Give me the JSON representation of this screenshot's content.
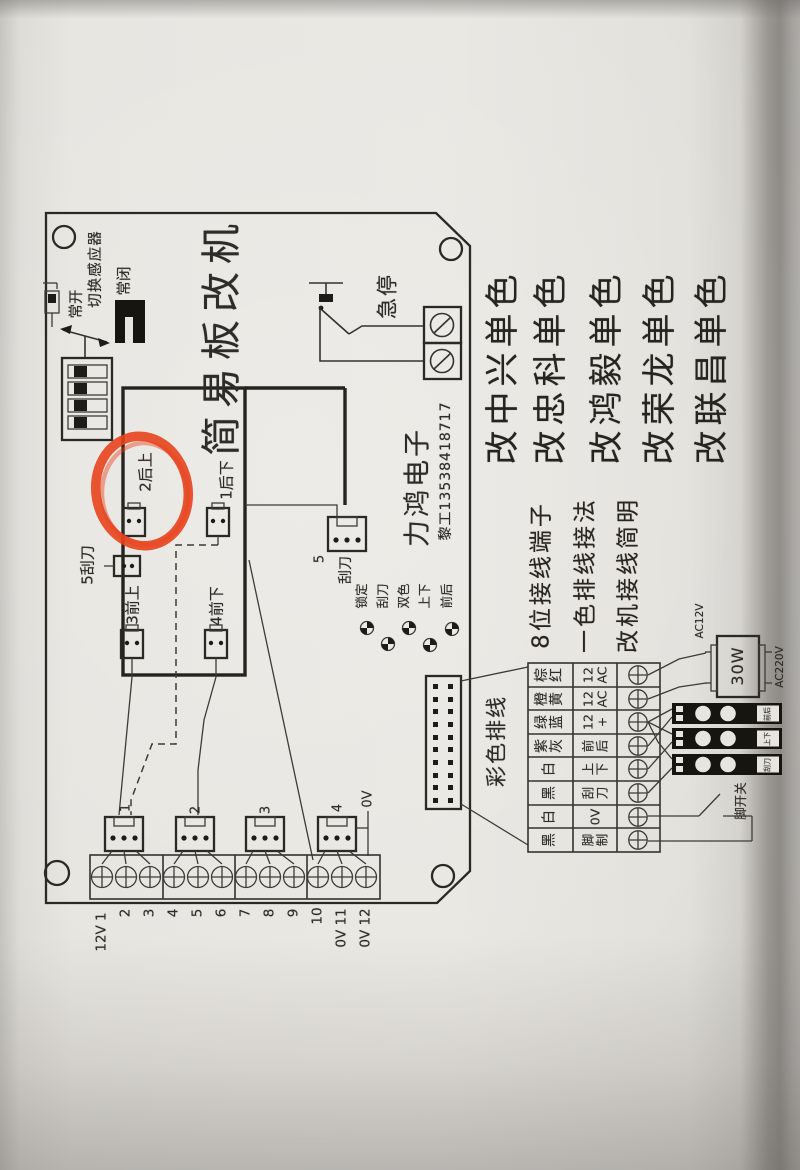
{
  "colors": {
    "marker_red": "#e8421c",
    "ink": "#2e2c28",
    "paper": "#e7e5e0"
  },
  "board": {
    "title": "简易板改机",
    "sensor": {
      "label": "切换感应器",
      "normally_open": "常开",
      "normally_closed": "常闭"
    },
    "estop_label": "急停",
    "connectors": {
      "rear_up": "2后上",
      "rear_down": "1后下",
      "scraper_side": "5刮刀",
      "front_up": "3前上",
      "front_down": "4前下",
      "scraper_num": "5",
      "scraper": "刮刀"
    },
    "company": {
      "name": "力鸿电子",
      "contact": "黎工13538418717"
    },
    "legend": [
      "锁定",
      "刮刀",
      "双色",
      "上下",
      "前后"
    ],
    "bottom_connector_numbers": [
      "1",
      "2",
      "3",
      "4"
    ],
    "zero_volt": "0V",
    "terminals": [
      "12V 1",
      "2",
      "3",
      "4",
      "5",
      "6",
      "7",
      "8",
      "9",
      "10",
      "0V 11",
      "0V 12"
    ]
  },
  "right": {
    "headlines": [
      "改中兴单色",
      "改忠科单色",
      "改鸿毅单色",
      "改荣龙单色",
      "改联昌单色"
    ],
    "notes": [
      "8位接线端子",
      "一色排线接法",
      "改机接线简明"
    ],
    "ribbon_label": "彩色排线",
    "table": {
      "rows": [
        {
          "color": [
            "棕",
            "红"
          ],
          "func": [
            "12",
            "AC"
          ]
        },
        {
          "color": [
            "橙",
            "黄"
          ],
          "func": [
            "12",
            "AC"
          ]
        },
        {
          "color": [
            "绿",
            "蓝"
          ],
          "func": [
            "12",
            "+"
          ]
        },
        {
          "color": [
            "紫",
            "灰"
          ],
          "func": [
            "前",
            "后"
          ]
        },
        {
          "color": [
            "白"
          ],
          "func": [
            "上",
            "下"
          ]
        },
        {
          "color": [
            "黑"
          ],
          "func": [
            "刮",
            "刀"
          ]
        },
        {
          "color": [
            "白"
          ],
          "func": [
            "0V"
          ]
        },
        {
          "color": [
            "黑"
          ],
          "func": [
            "脚",
            "制"
          ]
        }
      ]
    },
    "transformer": {
      "watt": "30W",
      "input": "AC220V",
      "output": "AC12V"
    },
    "module_tags": [
      "前后",
      "上下",
      "刮刀"
    ],
    "foot_switch": "脚开关"
  }
}
